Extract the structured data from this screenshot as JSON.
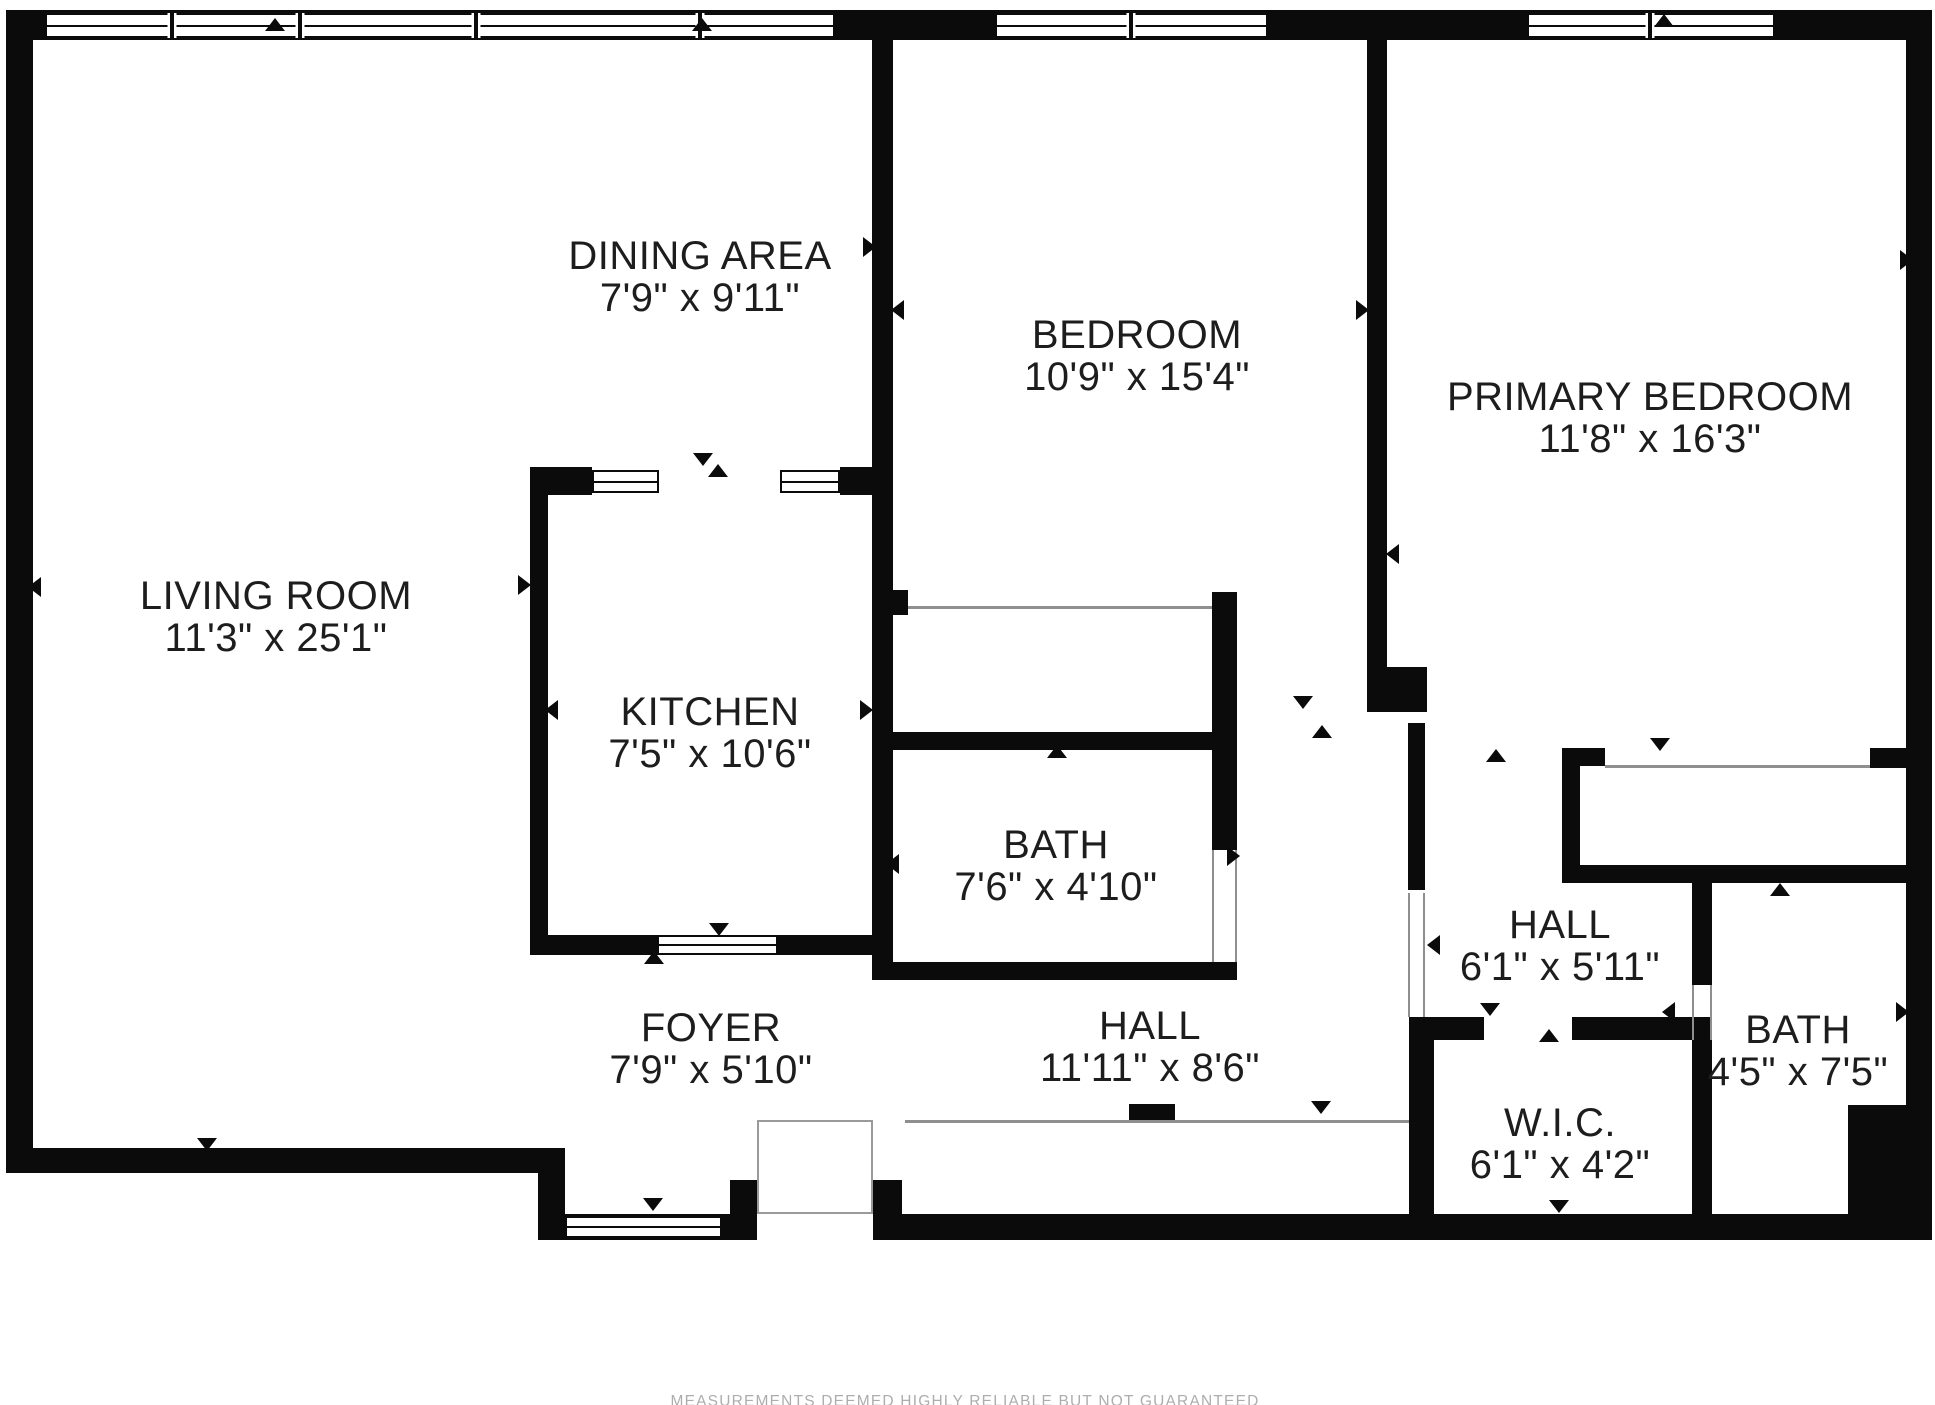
{
  "title": "apartment-floor-plan",
  "disclaimer": "MEASUREMENTS DEEMED HIGHLY RELIABLE BUT NOT GUARANTEED",
  "accent_colors": {
    "wall": "#0b0b0b",
    "thin_line": "#8f8f8f",
    "label_text": "#1d1d1d",
    "disclaimer_text": "#adadad"
  },
  "rooms": [
    {
      "id": "living-room",
      "name": "LIVING ROOM",
      "dims": "11'3\" x 25'1\"",
      "cx": 276,
      "cy": 596
    },
    {
      "id": "dining-area",
      "name": "DINING AREA",
      "dims": "7'9\" x 9'11\"",
      "cx": 700,
      "cy": 256
    },
    {
      "id": "bedroom",
      "name": "BEDROOM",
      "dims": "10'9\" x 15'4\"",
      "cx": 1137,
      "cy": 335
    },
    {
      "id": "primary-bedroom",
      "name": "PRIMARY BEDROOM",
      "dims": "11'8\" x 16'3\"",
      "cx": 1650,
      "cy": 397
    },
    {
      "id": "kitchen",
      "name": "KITCHEN",
      "dims": "7'5\" x 10'6\"",
      "cx": 710,
      "cy": 712
    },
    {
      "id": "bath",
      "name": "BATH",
      "dims": "7'6\" x 4'10\"",
      "cx": 1056,
      "cy": 845
    },
    {
      "id": "foyer",
      "name": "FOYER",
      "dims": "7'9\" x 5'10\"",
      "cx": 711,
      "cy": 1028
    },
    {
      "id": "hall",
      "name": "HALL",
      "dims": "11'11\" x 8'6\"",
      "cx": 1150,
      "cy": 1026
    },
    {
      "id": "hall-2",
      "name": "HALL",
      "dims": "6'1\" x 5'11\"",
      "cx": 1560,
      "cy": 925
    },
    {
      "id": "wic",
      "name": "W.I.C.",
      "dims": "6'1\" x 4'2\"",
      "cx": 1560,
      "cy": 1123
    },
    {
      "id": "bath-2",
      "name": "BATH",
      "dims": "4'5\" x 7'5\"",
      "cx": 1798,
      "cy": 1030
    }
  ],
  "walls": [
    {
      "n": "wall-top",
      "x": 6,
      "y": 10,
      "w": 1926,
      "h": 30
    },
    {
      "n": "wall-left",
      "x": 6,
      "y": 10,
      "w": 27,
      "h": 1163
    },
    {
      "n": "wall-right",
      "x": 1906,
      "y": 10,
      "w": 26,
      "h": 1230
    },
    {
      "n": "wall-living-bottom",
      "x": 6,
      "y": 1148,
      "w": 559,
      "h": 25
    },
    {
      "n": "wall-step",
      "x": 538,
      "y": 1148,
      "w": 27,
      "h": 92
    },
    {
      "n": "wall-bottom-band",
      "x": 543,
      "y": 1214,
      "w": 1389,
      "h": 26
    },
    {
      "n": "wall-kitchen-left",
      "x": 530,
      "y": 467,
      "w": 18,
      "h": 488
    },
    {
      "n": "wall-kitchen-top-left-block",
      "x": 530,
      "y": 467,
      "w": 62,
      "h": 28
    },
    {
      "n": "wall-kitchen-top-right-block",
      "x": 840,
      "y": 467,
      "w": 37,
      "h": 28
    },
    {
      "n": "wall-center-divider",
      "x": 872,
      "y": 40,
      "w": 21,
      "h": 940
    },
    {
      "n": "wall-kitchen-bottom-left",
      "x": 530,
      "y": 935,
      "w": 127,
      "h": 20
    },
    {
      "n": "wall-kitchen-bottom-right",
      "x": 778,
      "y": 935,
      "w": 115,
      "h": 20
    },
    {
      "n": "wall-bath-bottom",
      "x": 877,
      "y": 962,
      "w": 360,
      "h": 18
    },
    {
      "n": "wall-bath-top",
      "x": 893,
      "y": 732,
      "w": 327,
      "h": 18
    },
    {
      "n": "wall-bath-right",
      "x": 1212,
      "y": 592,
      "w": 25,
      "h": 258
    },
    {
      "n": "wall-bedroom-closet-stub",
      "x": 880,
      "y": 590,
      "w": 28,
      "h": 25
    },
    {
      "n": "wall-bedroom-divider",
      "x": 1367,
      "y": 40,
      "w": 20,
      "h": 627
    },
    {
      "n": "wall-bedroom-divider-block",
      "x": 1367,
      "y": 667,
      "w": 60,
      "h": 45
    },
    {
      "n": "wall-hall2-west",
      "x": 1408,
      "y": 723,
      "w": 17,
      "h": 167
    },
    {
      "n": "wall-wic-left",
      "x": 1409,
      "y": 1017,
      "w": 25,
      "h": 197
    },
    {
      "n": "wall-wic-top-left",
      "x": 1409,
      "y": 1017,
      "w": 75,
      "h": 23
    },
    {
      "n": "wall-wic-top-right",
      "x": 1572,
      "y": 1017,
      "w": 138,
      "h": 23
    },
    {
      "n": "wall-closet-left",
      "x": 1562,
      "y": 748,
      "w": 18,
      "h": 135
    },
    {
      "n": "wall-closet-top-block",
      "x": 1562,
      "y": 748,
      "w": 43,
      "h": 18
    },
    {
      "n": "wall-closet-right-block",
      "x": 1870,
      "y": 748,
      "w": 36,
      "h": 20
    },
    {
      "n": "wall-closet-bottom",
      "x": 1562,
      "y": 865,
      "w": 344,
      "h": 18
    },
    {
      "n": "wall-bath2-left-upper",
      "x": 1692,
      "y": 883,
      "w": 20,
      "h": 102
    },
    {
      "n": "wall-bath2-left-lower",
      "x": 1692,
      "y": 1040,
      "w": 20,
      "h": 174
    },
    {
      "n": "wall-bath2-notch",
      "x": 1848,
      "y": 1105,
      "w": 58,
      "h": 135
    },
    {
      "n": "wall-entry-post-left",
      "x": 730,
      "y": 1180,
      "w": 27,
      "h": 60
    },
    {
      "n": "wall-entry-post-right",
      "x": 873,
      "y": 1180,
      "w": 29,
      "h": 60
    },
    {
      "n": "wall-hall-closet-stub",
      "x": 1129,
      "y": 1104,
      "w": 46,
      "h": 18
    }
  ],
  "openings": [
    {
      "n": "entry-door-opening",
      "x": 757,
      "y": 1214,
      "w": 116,
      "h": 26
    }
  ],
  "windows": [
    {
      "n": "window-top-a",
      "x": 45,
      "y": 13,
      "w": 790,
      "h": 25,
      "mullions": [
        172,
        300,
        476,
        700
      ]
    },
    {
      "n": "window-top-b",
      "x": 995,
      "y": 13,
      "w": 273,
      "h": 25,
      "mullions": [
        1131
      ]
    },
    {
      "n": "window-top-c",
      "x": 1527,
      "y": 13,
      "w": 248,
      "h": 25,
      "mullions": [
        1650
      ]
    },
    {
      "n": "window-kitchen-top-1",
      "x": 592,
      "y": 470,
      "w": 67,
      "h": 23,
      "mullions": []
    },
    {
      "n": "window-kitchen-top-2",
      "x": 780,
      "y": 470,
      "w": 60,
      "h": 23,
      "mullions": []
    },
    {
      "n": "window-kitchen-bottom",
      "x": 657,
      "y": 935,
      "w": 121,
      "h": 20,
      "mullions": []
    },
    {
      "n": "window-foyer-bottom",
      "x": 565,
      "y": 1216,
      "w": 157,
      "h": 22,
      "mullions": []
    }
  ],
  "thin_lines": [
    {
      "n": "closet-line-bedroom",
      "x": 908,
      "y": 606,
      "w": 304,
      "h": 3
    },
    {
      "n": "closet-line-primary",
      "x": 1605,
      "y": 765,
      "w": 265,
      "h": 3
    },
    {
      "n": "closet-line-hall",
      "x": 905,
      "y": 1120,
      "w": 504,
      "h": 3
    },
    {
      "n": "jamb-hall2-west-a",
      "x": 1408,
      "y": 893,
      "w": 2,
      "h": 124
    },
    {
      "n": "jamb-hall2-west-b",
      "x": 1423,
      "y": 893,
      "w": 2,
      "h": 124
    },
    {
      "n": "jamb-bath2-a",
      "x": 1692,
      "y": 985,
      "w": 2,
      "h": 55
    },
    {
      "n": "jamb-bath2-b",
      "x": 1710,
      "y": 985,
      "w": 2,
      "h": 55
    },
    {
      "n": "jamb-bath-right-a",
      "x": 1212,
      "y": 850,
      "w": 2,
      "h": 112
    },
    {
      "n": "jamb-bath-right-b",
      "x": 1235,
      "y": 850,
      "w": 2,
      "h": 112
    }
  ],
  "thin_boxes": [
    {
      "n": "entry-threshold-box",
      "x": 757,
      "y": 1120,
      "w": 116,
      "h": 94
    }
  ],
  "door_markers": [
    {
      "x": 275,
      "y": 24,
      "dir": "up"
    },
    {
      "x": 702,
      "y": 24,
      "dir": "up"
    },
    {
      "x": 1303,
      "y": 24,
      "dir": "up"
    },
    {
      "x": 1664,
      "y": 20,
      "dir": "up"
    },
    {
      "x": 34,
      "y": 587,
      "dir": "left"
    },
    {
      "x": 524,
      "y": 585,
      "dir": "right"
    },
    {
      "x": 551,
      "y": 710,
      "dir": "left"
    },
    {
      "x": 703,
      "y": 459,
      "dir": "down"
    },
    {
      "x": 718,
      "y": 470,
      "dir": "up"
    },
    {
      "x": 869,
      "y": 247,
      "dir": "right"
    },
    {
      "x": 897,
      "y": 310,
      "dir": "left"
    },
    {
      "x": 1362,
      "y": 310,
      "dir": "right"
    },
    {
      "x": 866,
      "y": 710,
      "dir": "right"
    },
    {
      "x": 892,
      "y": 864,
      "dir": "left"
    },
    {
      "x": 1057,
      "y": 751,
      "dir": "up"
    },
    {
      "x": 1233,
      "y": 856,
      "dir": "right"
    },
    {
      "x": 719,
      "y": 929,
      "dir": "down"
    },
    {
      "x": 654,
      "y": 957,
      "dir": "up"
    },
    {
      "x": 1392,
      "y": 554,
      "dir": "left"
    },
    {
      "x": 1906,
      "y": 260,
      "dir": "right"
    },
    {
      "x": 1303,
      "y": 702,
      "dir": "down"
    },
    {
      "x": 1322,
      "y": 731,
      "dir": "up"
    },
    {
      "x": 1496,
      "y": 755,
      "dir": "up"
    },
    {
      "x": 1433,
      "y": 945,
      "dir": "left"
    },
    {
      "x": 1660,
      "y": 744,
      "dir": "down"
    },
    {
      "x": 1780,
      "y": 889,
      "dir": "up"
    },
    {
      "x": 1668,
      "y": 1012,
      "dir": "left"
    },
    {
      "x": 1902,
      "y": 1012,
      "dir": "right"
    },
    {
      "x": 1490,
      "y": 1009,
      "dir": "down"
    },
    {
      "x": 1549,
      "y": 1035,
      "dir": "up"
    },
    {
      "x": 1559,
      "y": 1206,
      "dir": "down"
    },
    {
      "x": 1321,
      "y": 1107,
      "dir": "down"
    },
    {
      "x": 653,
      "y": 1204,
      "dir": "down"
    },
    {
      "x": 207,
      "y": 1144,
      "dir": "down"
    }
  ]
}
